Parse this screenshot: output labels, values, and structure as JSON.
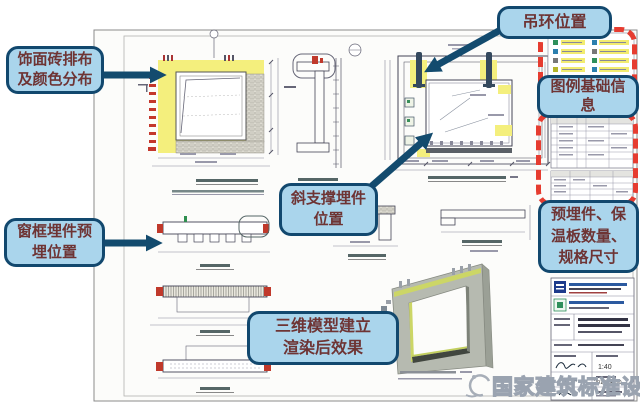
{
  "annotations": {
    "facing_brick": "饰面砖排布\n及颜色分布",
    "lifting_ring": "吊环位置",
    "diagonal_support": "斜支撑埋件\n位置",
    "window_frame_embed": "窗框埋件预\n埋位置",
    "model_render": "三维模型建立\n渲染后效果",
    "legend_info": "图例基础信\n息",
    "embed_quantity": "预埋件、保\n温板数量、\n规格尺寸"
  },
  "watermark": "国家建筑标准设计",
  "title_block": {
    "scale": "1:40",
    "date": "2013.04.30"
  },
  "colors": {
    "callout_fill": "#aad5ec",
    "callout_border": "#12486e",
    "callout_text": "#6e3434",
    "arrow": "#134b6e",
    "highlight_red": "#e63c30",
    "highlight_yellow": "#f4ef7d"
  }
}
